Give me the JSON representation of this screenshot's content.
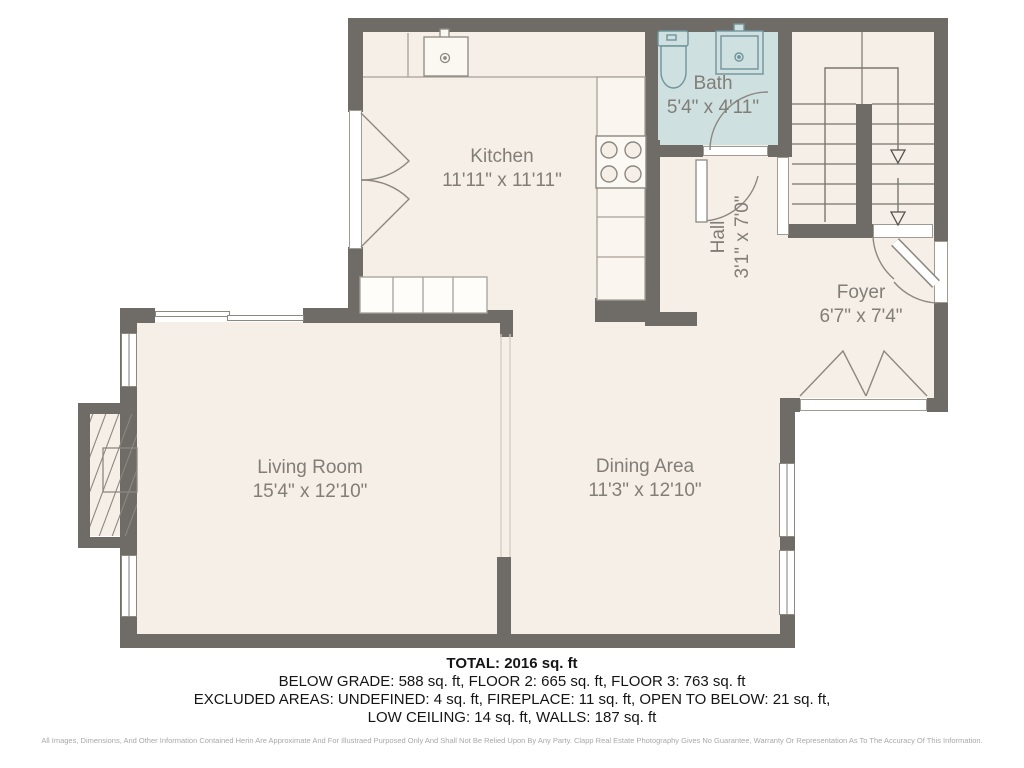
{
  "plan": {
    "title": "Floor plan",
    "rooms": [
      {
        "id": "kitchen",
        "name": "Kitchen",
        "dims": "11'11\" x 11'11\""
      },
      {
        "id": "bath",
        "name": "Bath",
        "dims": "5'4\" x 4'11\""
      },
      {
        "id": "hall",
        "name": "Hall",
        "dims": "3'1\" x 7'0\""
      },
      {
        "id": "foyer",
        "name": "Foyer",
        "dims": "6'7\" x 7'4\""
      },
      {
        "id": "living",
        "name": "Living Room",
        "dims": "15'4\" x 12'10\""
      },
      {
        "id": "dining",
        "name": "Dining Area",
        "dims": "11'3\" x 12'10\""
      }
    ],
    "colors": {
      "wall": "#6f6c67",
      "floor": "#f6efe7",
      "bath_floor": "#cfe0e0",
      "line": "#8c8880",
      "label_text": "#817d77"
    }
  },
  "summary": {
    "total": "TOTAL: 2016 sq. ft",
    "line2": "BELOW GRADE: 588 sq. ft, FLOOR 2: 665 sq. ft, FLOOR 3: 763 sq. ft",
    "line3": "EXCLUDED AREAS: UNDEFINED: 4 sq. ft, FIREPLACE: 11 sq. ft, OPEN TO BELOW: 21 sq. ft,",
    "line4": "LOW CEILING: 14 sq. ft, WALLS: 187 sq. ft",
    "disclaimer": "All Images, Dimensions, And Other Information Contained Herin Are Approximate And For Illustraed Purposed Only And Shall Not Be Relied Upon By Any Party. Clapp Real Estate Photography Gives No Guarantee, Warranty Or Representation As To The Accuracy Of This Information."
  }
}
